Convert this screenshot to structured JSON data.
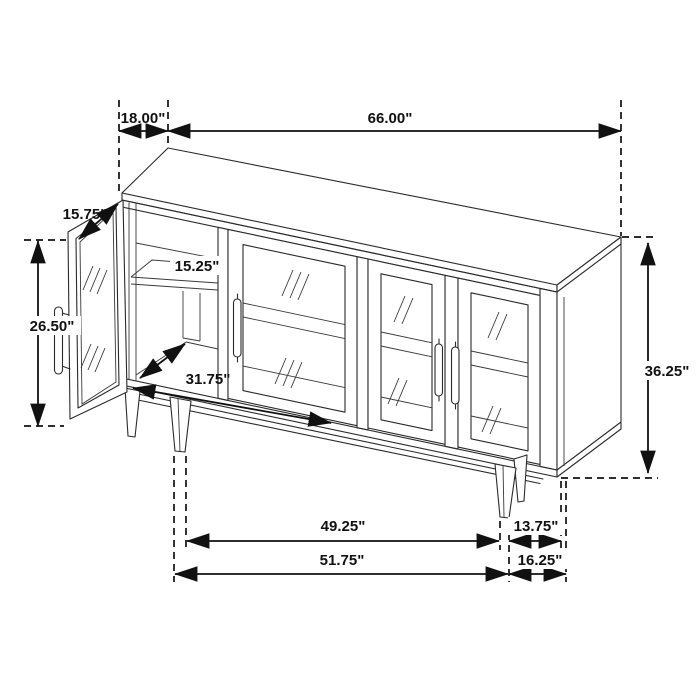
{
  "diagram": {
    "title": "Sideboard cabinet dimension drawing",
    "view": "isometric line drawing, open left glass door, four-door glass sideboard on tapered legs",
    "units": "inches"
  },
  "dimensions": {
    "top_depth": "18.00\"",
    "overall_width": "66.00\"",
    "door_width": "15.75\"",
    "door_height": "26.50\"",
    "shelf_depth": "15.25\"",
    "interior_width": "31.75\"",
    "overall_height": "36.25\"",
    "leg_span_inner": "49.25\"",
    "leg_to_edge": "13.75\"",
    "leg_span_outer": "51.75\"",
    "base_side_depth": "16.25\""
  },
  "colors": {
    "background": "#ffffff",
    "drawing_line": "#2b2b2b",
    "dimension_line": "#111111"
  }
}
